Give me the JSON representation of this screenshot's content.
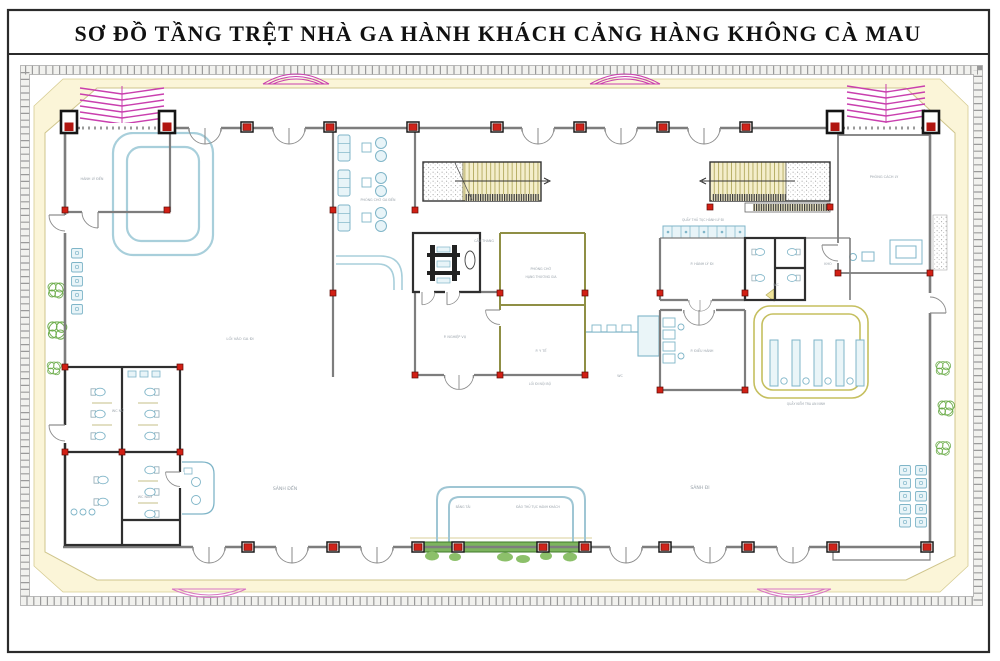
{
  "title_block": {
    "text": "SƠ ĐỒ TẦNG TRỆT NHÀ GA HÀNH KHÁCH CẢNG HÀNG KHÔNG CÀ MAU"
  },
  "drawing": {
    "type": "architectural-floor-plan",
    "subject": "Ground floor plan of the passenger terminal, Ca Mau airport",
    "palette": {
      "wall_gray": "#7d7d7d",
      "dark_wall": "#2f2f2f",
      "olive_wall": "#8f8f45",
      "canopy_magenta": "#c93fae",
      "fixture_cyan": "#7fb5c8",
      "fixture_cyan_fill": "#e8f4f8",
      "column_red": "#cf231a",
      "apron_cream": "#fbf5d8",
      "apron_line": "#cfc58c",
      "plant_green": "#6fae4e",
      "counter_green": "#7cb45e",
      "stair_tread": "#f4eecb",
      "label_gray": "#9aa3ab"
    },
    "room_labels": [
      {
        "text": "HÀNH LÝ ĐẾN",
        "x": 92,
        "y": 180,
        "size": 3.4
      },
      {
        "text": "LỐI VÀO GA ĐI",
        "x": 240,
        "y": 340,
        "size": 3.8
      },
      {
        "text": "PHÒNG CHỜ GA ĐẾN",
        "x": 378,
        "y": 201,
        "size": 3.3
      },
      {
        "text": "CẦU THANG",
        "x": 484,
        "y": 242,
        "size": 3.3
      },
      {
        "text": "P. NGHIỆP VỤ",
        "x": 455,
        "y": 338,
        "size": 3.4
      },
      {
        "text": "PHÒNG CHỜ",
        "x": 541,
        "y": 270,
        "size": 3.3
      },
      {
        "text": "HẠNG THƯƠNG GIA",
        "x": 541,
        "y": 278,
        "size": 3.1
      },
      {
        "text": "P. Y TẾ",
        "x": 541,
        "y": 352,
        "size": 3.4
      },
      {
        "text": "QUẦY THỦ TỤC HÀNH LÝ ĐI",
        "x": 703,
        "y": 221,
        "size": 3.1
      },
      {
        "text": "P. HÀNH LÝ ĐI",
        "x": 702,
        "y": 265,
        "size": 3.4
      },
      {
        "text": "WC",
        "x": 776,
        "y": 286,
        "size": 3.4
      },
      {
        "text": "KHO",
        "x": 828,
        "y": 265,
        "size": 3.4
      },
      {
        "text": "PHÒNG CÁCH LY",
        "x": 884,
        "y": 178,
        "size": 3.5
      },
      {
        "text": "P. ĐIỀU HÀNH",
        "x": 702,
        "y": 352,
        "size": 3.4
      },
      {
        "text": "QUẦY KIỂM TRA AN NINH",
        "x": 806,
        "y": 405,
        "size": 3.1
      },
      {
        "text": "SẢNH ĐẾN",
        "x": 285,
        "y": 490,
        "size": 4.6
      },
      {
        "text": "SẢNH ĐI",
        "x": 700,
        "y": 489,
        "size": 4.6
      },
      {
        "text": "BĂNG TẢI",
        "x": 463,
        "y": 508,
        "size": 3.1
      },
      {
        "text": "ĐẢO THỦ TỤC HÀNH KHÁCH",
        "x": 538,
        "y": 508,
        "size": 3.1
      },
      {
        "text": "LỐI ĐI NỘI BỘ",
        "x": 540,
        "y": 385,
        "size": 3.2
      },
      {
        "text": "WC",
        "x": 620,
        "y": 377,
        "size": 3.3
      },
      {
        "text": "WC NỮ",
        "x": 118,
        "y": 412,
        "size": 3.4
      },
      {
        "text": "WC NAM",
        "x": 145,
        "y": 498,
        "size": 3.4
      }
    ]
  }
}
